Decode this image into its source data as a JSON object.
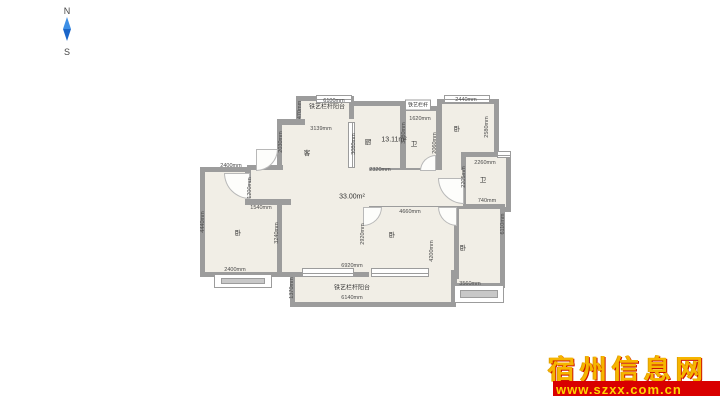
{
  "compass": {
    "north": "N",
    "south": "S",
    "needle_color_top": "#3d8fe6",
    "needle_color_bottom": "#1b66c9"
  },
  "watermark": {
    "site_name": "宿州信息网",
    "url": "www.szxx.com.cn",
    "name_color": "#f6b500",
    "bar_color": "#d90000",
    "url_color": "#ffd400"
  },
  "plan": {
    "wall_color": "#9c9c9c",
    "floor_color": "#f1eee6",
    "rooms": [
      {
        "name": "balcony-top-left",
        "x": 296,
        "y": 96,
        "w": 58,
        "h": 30,
        "b": [
          5,
          5,
          1,
          5
        ]
      },
      {
        "name": "kitchen",
        "x": 349,
        "y": 101,
        "w": 56,
        "h": 72,
        "b": [
          5,
          5,
          5,
          5
        ]
      },
      {
        "name": "bath-top",
        "x": 401,
        "y": 106,
        "w": 40,
        "h": 67,
        "b": [
          5,
          5,
          5,
          5
        ]
      },
      {
        "name": "bedroom-top-right",
        "x": 437,
        "y": 99,
        "w": 62,
        "h": 78,
        "b": [
          5,
          5,
          5,
          5
        ]
      },
      {
        "name": "bath-right",
        "x": 461,
        "y": 152,
        "w": 50,
        "h": 60,
        "b": [
          5,
          5,
          5,
          5
        ]
      },
      {
        "name": "bedroom-bottom-right",
        "x": 452,
        "y": 204,
        "w": 53,
        "h": 84,
        "b": [
          5,
          5,
          5,
          5
        ]
      },
      {
        "name": "bedroom-bottom-middle",
        "x": 357,
        "y": 202,
        "w": 102,
        "h": 77,
        "b": [
          5,
          5,
          5,
          5
        ]
      },
      {
        "name": "balcony-bottom",
        "x": 290,
        "y": 270,
        "w": 166,
        "h": 37,
        "b": [
          0,
          5,
          5,
          5
        ]
      },
      {
        "name": "bedroom-bottom-left",
        "x": 200,
        "y": 167,
        "w": 88,
        "h": 110,
        "b": [
          5,
          5,
          5,
          5
        ]
      },
      {
        "name": "living-room",
        "x": 277,
        "y": 119,
        "w": 92,
        "h": 158,
        "b": [
          0,
          0,
          5,
          5
        ]
      },
      {
        "name": "hallway",
        "x": 360,
        "y": 170,
        "w": 103,
        "h": 36,
        "b": [
          0,
          0,
          0,
          0
        ]
      },
      {
        "name": "entry-nook",
        "x": 247,
        "y": 165,
        "w": 36,
        "h": 40,
        "b": [
          5,
          0,
          0,
          0
        ]
      }
    ],
    "wall_segments": [
      {
        "name": "living-top-stub",
        "x": 277,
        "y": 119,
        "w": 28,
        "h": 6
      },
      {
        "name": "nook-bottom-wall",
        "x": 245,
        "y": 199,
        "w": 46,
        "h": 6
      },
      {
        "name": "nook-left-stub",
        "x": 245,
        "y": 170,
        "w": 6,
        "h": 12
      }
    ],
    "windows": [
      {
        "name": "window-top-balcony",
        "x": 316,
        "y": 95,
        "w": 36,
        "h": 8,
        "o": "h"
      },
      {
        "name": "window-bedroom-top-right",
        "x": 444,
        "y": 95,
        "w": 46,
        "h": 8,
        "o": "h"
      },
      {
        "name": "window-bath-right",
        "x": 497,
        "y": 151,
        "w": 14,
        "h": 7,
        "o": "h"
      },
      {
        "name": "window-kitchen-left",
        "x": 348,
        "y": 122,
        "w": 7,
        "h": 46,
        "o": "v"
      },
      {
        "name": "window-living-bottom",
        "x": 302,
        "y": 268,
        "w": 52,
        "h": 9,
        "o": "h"
      },
      {
        "name": "window-bedroom-middle-bottom",
        "x": 371,
        "y": 268,
        "w": 58,
        "h": 9,
        "o": "h"
      }
    ],
    "bay_windows": [
      {
        "name": "bay-window-bottom-left",
        "x": 214,
        "y": 274,
        "w": 58,
        "h": 14
      },
      {
        "name": "bay-window-bottom-right",
        "x": 454,
        "y": 285,
        "w": 50,
        "h": 18
      }
    ],
    "doors": [
      {
        "name": "door-bedroom-bottom-left",
        "x": 224,
        "y": 173,
        "s": 26,
        "c": "bl"
      },
      {
        "name": "door-living-left",
        "x": 256,
        "y": 149,
        "s": 22,
        "c": "br"
      },
      {
        "name": "door-bedroom-middle-left",
        "x": 363,
        "y": 207,
        "s": 19,
        "c": "br"
      },
      {
        "name": "door-bedroom-middle-right",
        "x": 438,
        "y": 207,
        "s": 19,
        "c": "bl"
      },
      {
        "name": "door-bath-top",
        "x": 420,
        "y": 155,
        "s": 16,
        "c": "tl"
      },
      {
        "name": "door-entry",
        "x": 438,
        "y": 178,
        "s": 26,
        "c": "bl"
      }
    ],
    "labels": [
      {
        "text": "铁艺栏杆阳台",
        "x": 327,
        "y": 106,
        "kind": "balcony"
      },
      {
        "text": "铁艺栏杆阳台",
        "x": 352,
        "y": 287,
        "kind": "balcony"
      },
      {
        "text": "铁艺栏杆",
        "x": 418,
        "y": 105,
        "kind": "box"
      },
      {
        "text": "卧",
        "x": 238,
        "y": 232,
        "kind": "room"
      },
      {
        "text": "客",
        "x": 307,
        "y": 152,
        "kind": "room"
      },
      {
        "text": "厨",
        "x": 368,
        "y": 141,
        "kind": "room"
      },
      {
        "text": "卫",
        "x": 414,
        "y": 143,
        "kind": "room"
      },
      {
        "text": "卧",
        "x": 457,
        "y": 128,
        "kind": "room"
      },
      {
        "text": "卫",
        "x": 483,
        "y": 179,
        "kind": "room"
      },
      {
        "text": "卧",
        "x": 392,
        "y": 234,
        "kind": "room"
      },
      {
        "text": "卧",
        "x": 463,
        "y": 247,
        "kind": "room"
      },
      {
        "text": "13.11m²",
        "x": 394,
        "y": 140,
        "kind": "area"
      },
      {
        "text": "33.00m²",
        "x": 352,
        "y": 197,
        "kind": "area"
      },
      {
        "text": "6100mm",
        "x": 334,
        "y": 101,
        "kind": "dim"
      },
      {
        "text": "2440mm",
        "x": 466,
        "y": 100,
        "kind": "dim"
      },
      {
        "text": "1620mm",
        "x": 420,
        "y": 119,
        "kind": "dim"
      },
      {
        "text": "3139mm",
        "x": 321,
        "y": 129,
        "kind": "dim"
      },
      {
        "text": "470mm",
        "x": 300,
        "y": 110,
        "rot": 1,
        "kind": "dim"
      },
      {
        "text": "2030mm",
        "x": 281,
        "y": 142,
        "rot": 1,
        "kind": "dim"
      },
      {
        "text": "3080mm",
        "x": 354,
        "y": 144,
        "rot": 1,
        "kind": "dim"
      },
      {
        "text": "3280mm",
        "x": 404,
        "y": 133,
        "rot": 1,
        "kind": "dim"
      },
      {
        "text": "2060mm",
        "x": 435,
        "y": 143,
        "rot": 1,
        "kind": "dim"
      },
      {
        "text": "2580mm",
        "x": 487,
        "y": 127,
        "rot": 1,
        "kind": "dim"
      },
      {
        "text": "2320mm",
        "x": 380,
        "y": 170,
        "kind": "dim"
      },
      {
        "text": "2400mm",
        "x": 231,
        "y": 166,
        "kind": "dim"
      },
      {
        "text": "1200mm",
        "x": 250,
        "y": 188,
        "rot": 1,
        "kind": "dim"
      },
      {
        "text": "1540mm",
        "x": 261,
        "y": 208,
        "kind": "dim"
      },
      {
        "text": "4440mm",
        "x": 203,
        "y": 222,
        "rot": 1,
        "kind": "dim"
      },
      {
        "text": "3240mm",
        "x": 277,
        "y": 233,
        "rot": 1,
        "kind": "dim"
      },
      {
        "text": "2400mm",
        "x": 235,
        "y": 270,
        "kind": "dim"
      },
      {
        "text": "6920mm",
        "x": 352,
        "y": 266,
        "kind": "dim"
      },
      {
        "text": "1370mm",
        "x": 292,
        "y": 288,
        "rot": 1,
        "kind": "dim"
      },
      {
        "text": "6140mm",
        "x": 352,
        "y": 298,
        "kind": "dim"
      },
      {
        "text": "4660mm",
        "x": 410,
        "y": 212,
        "kind": "dim"
      },
      {
        "text": "2920mm",
        "x": 363,
        "y": 234,
        "rot": 1,
        "kind": "dim"
      },
      {
        "text": "4200mm",
        "x": 432,
        "y": 251,
        "rot": 1,
        "kind": "dim"
      },
      {
        "text": "2260mm",
        "x": 485,
        "y": 163,
        "kind": "dim"
      },
      {
        "text": "2205mm",
        "x": 464,
        "y": 177,
        "rot": 1,
        "kind": "dim"
      },
      {
        "text": "740mm",
        "x": 487,
        "y": 201,
        "kind": "dim"
      },
      {
        "text": "6110mm",
        "x": 503,
        "y": 224,
        "rot": 1,
        "kind": "dim"
      },
      {
        "text": "3560mm",
        "x": 470,
        "y": 284,
        "kind": "dim"
      }
    ]
  }
}
